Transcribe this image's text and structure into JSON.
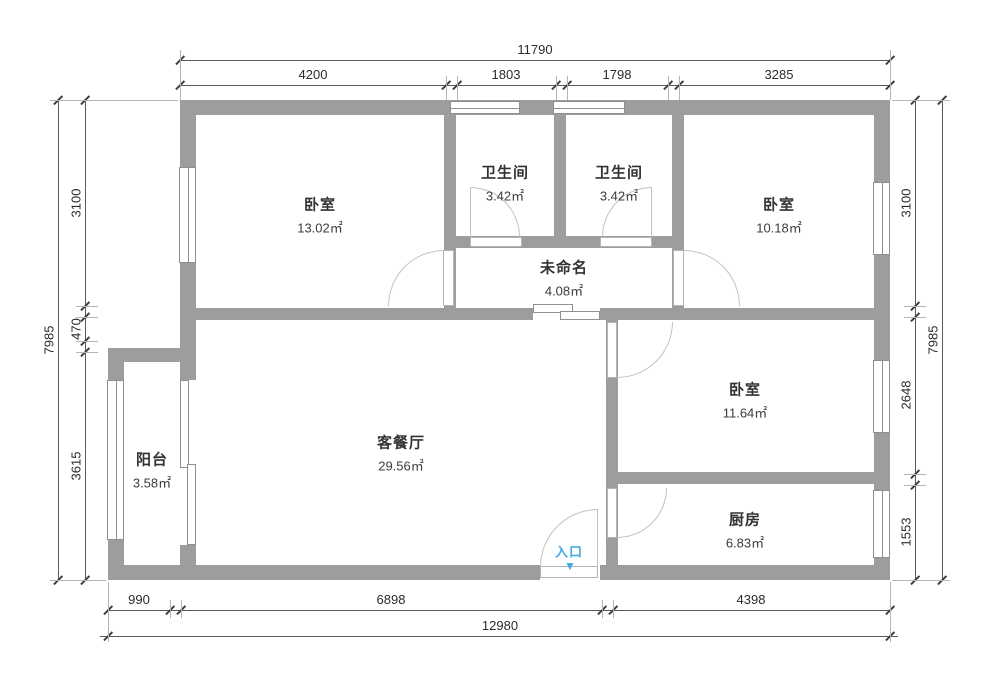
{
  "colors": {
    "wall": "#9d9d9d",
    "accent": "#3fa9e0",
    "dimension_line": "#5a5a5a",
    "text": "#333333"
  },
  "rooms": [
    {
      "id": "bedroom-top-left",
      "name": "卧室",
      "area": "13.02㎡"
    },
    {
      "id": "bathroom-left",
      "name": "卫生间",
      "area": "3.42㎡"
    },
    {
      "id": "bathroom-right",
      "name": "卫生间",
      "area": "3.42㎡"
    },
    {
      "id": "bedroom-top-right",
      "name": "卧室",
      "area": "10.18㎡"
    },
    {
      "id": "hallway-unnamed",
      "name": "未命名",
      "area": "4.08㎡"
    },
    {
      "id": "living-dining",
      "name": "客餐厅",
      "area": "29.56㎡"
    },
    {
      "id": "balcony",
      "name": "阳台",
      "area": "3.58㎡"
    },
    {
      "id": "bedroom-right",
      "name": "卧室",
      "area": "11.64㎡"
    },
    {
      "id": "kitchen",
      "name": "厨房",
      "area": "6.83㎡"
    }
  ],
  "entrance": {
    "label": "入口",
    "arrow": "▼"
  },
  "dimensions": {
    "top": {
      "total": "11790",
      "segments": [
        "4200",
        "1803",
        "1798",
        "3285"
      ]
    },
    "bottom": {
      "total": "12980",
      "segments": [
        "990",
        "6898",
        "4398"
      ]
    },
    "left": {
      "total": "7985",
      "segments": [
        "3100",
        "470",
        "3615"
      ]
    },
    "right": {
      "total": "7985",
      "segments": [
        "3100",
        "2648",
        "1553"
      ]
    }
  }
}
